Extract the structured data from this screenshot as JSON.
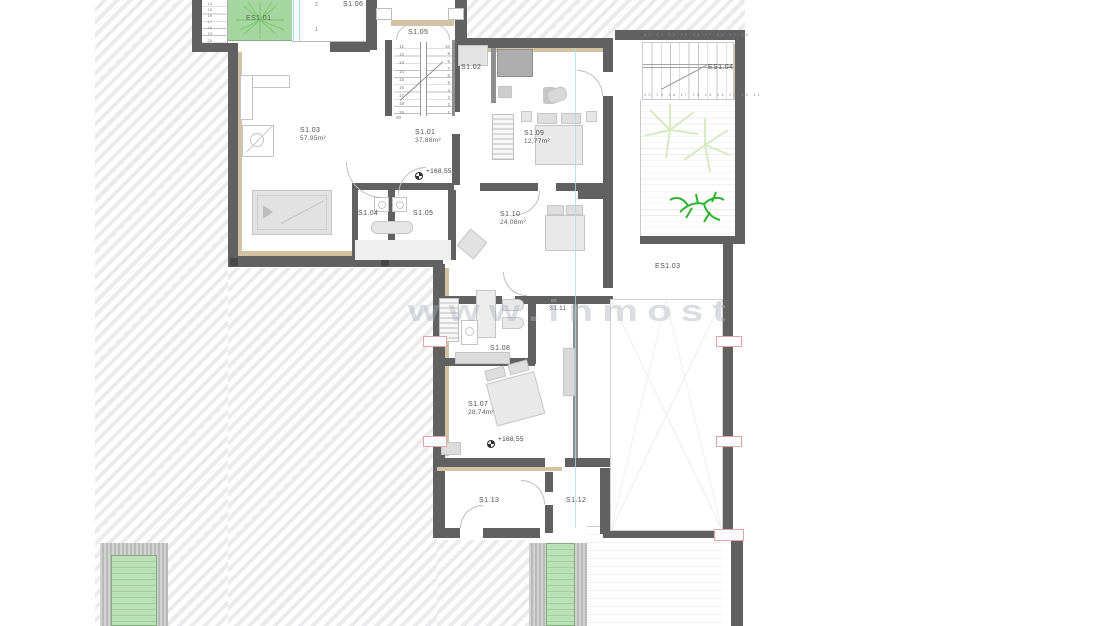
{
  "drawing": {
    "watermark": "www.inmost",
    "rooms": {
      "es101": {
        "label": "ES1.01"
      },
      "s106": {
        "label": "S1.06"
      },
      "s105_stair": {
        "label": "S1.05"
      },
      "s102": {
        "label": "S1.02"
      },
      "s103": {
        "label": "S1.03",
        "area": "57,95m²"
      },
      "s101": {
        "label": "S1.01",
        "area": "37,86m²"
      },
      "s109": {
        "label": "S1.09",
        "area": "12,77m²"
      },
      "es104": {
        "label": "ES1.04"
      },
      "s104": {
        "label": "S1.04"
      },
      "s105_bath": {
        "label": "S1.05"
      },
      "s110": {
        "label": "S1.10",
        "area": "24,08m²"
      },
      "es103": {
        "label": "ES1.03"
      },
      "s111": {
        "label": "S1.11"
      },
      "s108": {
        "label": "S1.08"
      },
      "s107": {
        "label": "S1.07",
        "area": "28,74m²"
      },
      "s113": {
        "label": "S1.13"
      },
      "s112": {
        "label": "S1.12"
      }
    },
    "levels": {
      "upper": "+168,55",
      "lower": "+168,55"
    },
    "stairs": {
      "s105": {
        "left": "11\n12\n13\n14\n15\n16\n17\n18\n19",
        "right": "10\n9\n8\n7\n6\n5\n4\n3\n2\n1",
        "last": "20"
      },
      "es101": {
        "nums": "14\n15\n16\n17\n18\n19\n20"
      },
      "es104": {
        "top": "02 03 04 05 06 07 08 09 10",
        "bottom": "20 19 18 17 16 15 14 13 12 11"
      }
    },
    "dims": {
      "a": "2",
      "b": "1"
    },
    "colors": {
      "wall": "#616161",
      "lining": "#d3c3a2",
      "green": "#a6d69f",
      "tie_red": "#dfa6a6",
      "cyan": "#a8dce8",
      "plant_green": "#2db52d"
    }
  }
}
